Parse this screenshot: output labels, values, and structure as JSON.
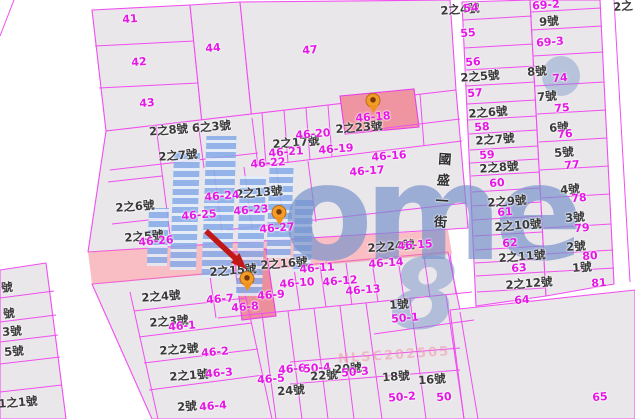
{
  "map": {
    "street_name": "國盛一街",
    "watermark_logo": "ome",
    "watermark_glyph": "8",
    "watermark_code": "NLSC202505",
    "colors": {
      "boundary": "#f04ef0",
      "lot_text": "#e517e5",
      "house_text": "#3a3a3a",
      "highlight_parcel": "#ee95a1",
      "highlight_road": "#f2909c",
      "pin": "#f59b28",
      "arrow": "#c21717",
      "watermark_blue": "#86ace9"
    },
    "labels": [
      {
        "text": "41",
        "x": 130,
        "y": 19,
        "t": "l"
      },
      {
        "text": "42",
        "x": 139,
        "y": 62,
        "t": "l"
      },
      {
        "text": "43",
        "x": 147,
        "y": 103,
        "t": "l"
      },
      {
        "text": "44",
        "x": 213,
        "y": 48,
        "t": "l"
      },
      {
        "text": "47",
        "x": 310,
        "y": 50,
        "t": "l"
      },
      {
        "text": "2之8號 6之3號",
        "x": 190,
        "y": 129,
        "t": "h"
      },
      {
        "text": "2之7號",
        "x": 178,
        "y": 156,
        "t": "h"
      },
      {
        "text": "2之17號",
        "x": 296,
        "y": 143,
        "t": "h"
      },
      {
        "text": "46-20",
        "x": 313,
        "y": 134,
        "t": "l"
      },
      {
        "text": "46-21",
        "x": 286,
        "y": 152,
        "t": "l"
      },
      {
        "text": "46-22",
        "x": 268,
        "y": 163,
        "t": "l"
      },
      {
        "text": "46-19",
        "x": 336,
        "y": 149,
        "t": "l"
      },
      {
        "text": "46-16",
        "x": 389,
        "y": 156,
        "t": "l"
      },
      {
        "text": "46-17",
        "x": 367,
        "y": 171,
        "t": "l"
      },
      {
        "text": "2之23號",
        "x": 359,
        "y": 128,
        "t": "h"
      },
      {
        "text": "46-18",
        "x": 373,
        "y": 117,
        "t": "l"
      },
      {
        "text": "2之13號",
        "x": 259,
        "y": 193,
        "t": "h"
      },
      {
        "text": "46-24",
        "x": 222,
        "y": 196,
        "t": "l"
      },
      {
        "text": "46-23",
        "x": 251,
        "y": 210,
        "t": "l"
      },
      {
        "text": "46-25",
        "x": 199,
        "y": 215,
        "t": "l"
      },
      {
        "text": "46-27",
        "x": 277,
        "y": 228,
        "t": "l"
      },
      {
        "text": "2之6號",
        "x": 135,
        "y": 207,
        "t": "h"
      },
      {
        "text": "2之5號",
        "x": 144,
        "y": 237,
        "t": "h"
      },
      {
        "text": "46-26",
        "x": 156,
        "y": 241,
        "t": "l"
      },
      {
        "text": "2之15號",
        "x": 233,
        "y": 271,
        "t": "h"
      },
      {
        "text": "2之16號",
        "x": 284,
        "y": 264,
        "t": "h"
      },
      {
        "text": "46-11",
        "x": 317,
        "y": 268,
        "t": "l"
      },
      {
        "text": "2之24號",
        "x": 391,
        "y": 247,
        "t": "h"
      },
      {
        "text": "46-15",
        "x": 415,
        "y": 245,
        "t": "l"
      },
      {
        "text": "46-14",
        "x": 386,
        "y": 263,
        "t": "l"
      },
      {
        "text": "46-10",
        "x": 297,
        "y": 283,
        "t": "l"
      },
      {
        "text": "46-12",
        "x": 340,
        "y": 281,
        "t": "l"
      },
      {
        "text": "46-9",
        "x": 271,
        "y": 295,
        "t": "l"
      },
      {
        "text": "46-13",
        "x": 363,
        "y": 290,
        "t": "l"
      },
      {
        "text": "46-7",
        "x": 220,
        "y": 299,
        "t": "l"
      },
      {
        "text": "46-8",
        "x": 245,
        "y": 307,
        "t": "l"
      },
      {
        "text": "1號",
        "x": 399,
        "y": 305,
        "t": "h"
      },
      {
        "text": "50-1",
        "x": 405,
        "y": 318,
        "t": "l"
      },
      {
        "text": "2之4號",
        "x": 161,
        "y": 297,
        "t": "h"
      },
      {
        "text": "2之3號",
        "x": 169,
        "y": 322,
        "t": "h"
      },
      {
        "text": "46-1",
        "x": 182,
        "y": 326,
        "t": "l"
      },
      {
        "text": "2之2號",
        "x": 179,
        "y": 350,
        "t": "h"
      },
      {
        "text": "46-2",
        "x": 215,
        "y": 352,
        "t": "l"
      },
      {
        "text": "2之1號",
        "x": 189,
        "y": 376,
        "t": "h"
      },
      {
        "text": "46-3",
        "x": 219,
        "y": 373,
        "t": "l"
      },
      {
        "text": "2號",
        "x": 187,
        "y": 407,
        "t": "h"
      },
      {
        "text": "46-4",
        "x": 213,
        "y": 406,
        "t": "l"
      },
      {
        "text": "46-5",
        "x": 271,
        "y": 379,
        "t": "l"
      },
      {
        "text": "46-6",
        "x": 292,
        "y": 369,
        "t": "l"
      },
      {
        "text": "50-4",
        "x": 317,
        "y": 368,
        "t": "l"
      },
      {
        "text": "22號",
        "x": 324,
        "y": 376,
        "t": "h"
      },
      {
        "text": "20號",
        "x": 348,
        "y": 369,
        "t": "h"
      },
      {
        "text": "50-3",
        "x": 355,
        "y": 372,
        "t": "l"
      },
      {
        "text": "24號",
        "x": 291,
        "y": 391,
        "t": "h"
      },
      {
        "text": "18號",
        "x": 396,
        "y": 377,
        "t": "h"
      },
      {
        "text": "50-2",
        "x": 402,
        "y": 397,
        "t": "l"
      },
      {
        "text": "16號",
        "x": 432,
        "y": 380,
        "t": "h"
      },
      {
        "text": "50",
        "x": 444,
        "y": 397,
        "t": "l"
      },
      {
        "text": "號",
        "x": 7,
        "y": 288,
        "t": "h"
      },
      {
        "text": "號",
        "x": 9,
        "y": 314,
        "t": "h"
      },
      {
        "text": "3號",
        "x": 12,
        "y": 332,
        "t": "h"
      },
      {
        "text": "5號",
        "x": 14,
        "y": 352,
        "t": "h"
      },
      {
        "text": "1之1號",
        "x": 18,
        "y": 403,
        "t": "h"
      },
      {
        "text": "2之4號",
        "x": 460,
        "y": 10,
        "t": "h"
      },
      {
        "text": "54",
        "x": 471,
        "y": 8,
        "t": "l"
      },
      {
        "text": "55",
        "x": 468,
        "y": 33,
        "t": "l"
      },
      {
        "text": "56",
        "x": 473,
        "y": 62,
        "t": "l"
      },
      {
        "text": "2之5號",
        "x": 480,
        "y": 77,
        "t": "h"
      },
      {
        "text": "57",
        "x": 475,
        "y": 93,
        "t": "l"
      },
      {
        "text": "2之6號",
        "x": 488,
        "y": 113,
        "t": "h"
      },
      {
        "text": "58",
        "x": 482,
        "y": 127,
        "t": "l"
      },
      {
        "text": "2之7號",
        "x": 495,
        "y": 140,
        "t": "h"
      },
      {
        "text": "59",
        "x": 487,
        "y": 155,
        "t": "l"
      },
      {
        "text": "2之8號",
        "x": 499,
        "y": 168,
        "t": "h"
      },
      {
        "text": "60",
        "x": 497,
        "y": 183,
        "t": "l"
      },
      {
        "text": "2之9號",
        "x": 507,
        "y": 202,
        "t": "h"
      },
      {
        "text": "61",
        "x": 505,
        "y": 212,
        "t": "l"
      },
      {
        "text": "2之10號",
        "x": 518,
        "y": 226,
        "t": "h"
      },
      {
        "text": "62",
        "x": 510,
        "y": 243,
        "t": "l"
      },
      {
        "text": "2之11號",
        "x": 522,
        "y": 257,
        "t": "h"
      },
      {
        "text": "63",
        "x": 519,
        "y": 268,
        "t": "l"
      },
      {
        "text": "2之12號",
        "x": 529,
        "y": 284,
        "t": "h"
      },
      {
        "text": "64",
        "x": 522,
        "y": 300,
        "t": "l"
      },
      {
        "text": "69-2",
        "x": 546,
        "y": 5,
        "t": "l"
      },
      {
        "text": "9號",
        "x": 549,
        "y": 22,
        "t": "h"
      },
      {
        "text": "69-3",
        "x": 550,
        "y": 42,
        "t": "l"
      },
      {
        "text": "8號",
        "x": 537,
        "y": 72,
        "t": "h"
      },
      {
        "text": "74",
        "x": 560,
        "y": 78,
        "t": "l"
      },
      {
        "text": "7號",
        "x": 547,
        "y": 97,
        "t": "h"
      },
      {
        "text": "75",
        "x": 562,
        "y": 108,
        "t": "l"
      },
      {
        "text": "6號",
        "x": 559,
        "y": 128,
        "t": "h"
      },
      {
        "text": "76",
        "x": 565,
        "y": 134,
        "t": "l"
      },
      {
        "text": "5號",
        "x": 564,
        "y": 153,
        "t": "h"
      },
      {
        "text": "77",
        "x": 572,
        "y": 165,
        "t": "l"
      },
      {
        "text": "4號",
        "x": 570,
        "y": 190,
        "t": "h"
      },
      {
        "text": "78",
        "x": 579,
        "y": 198,
        "t": "l"
      },
      {
        "text": "3號",
        "x": 575,
        "y": 218,
        "t": "h"
      },
      {
        "text": "79",
        "x": 582,
        "y": 228,
        "t": "l"
      },
      {
        "text": "2號",
        "x": 576,
        "y": 247,
        "t": "h"
      },
      {
        "text": "80",
        "x": 590,
        "y": 256,
        "t": "l"
      },
      {
        "text": "1號",
        "x": 582,
        "y": 268,
        "t": "h"
      },
      {
        "text": "81",
        "x": 599,
        "y": 283,
        "t": "l"
      },
      {
        "text": "65",
        "x": 600,
        "y": 397,
        "t": "l"
      },
      {
        "text": "2之",
        "x": 623,
        "y": 7,
        "t": "h"
      }
    ],
    "pins": [
      {
        "x": 373,
        "y": 112
      },
      {
        "x": 279,
        "y": 224
      },
      {
        "x": 247,
        "y": 290
      }
    ]
  }
}
